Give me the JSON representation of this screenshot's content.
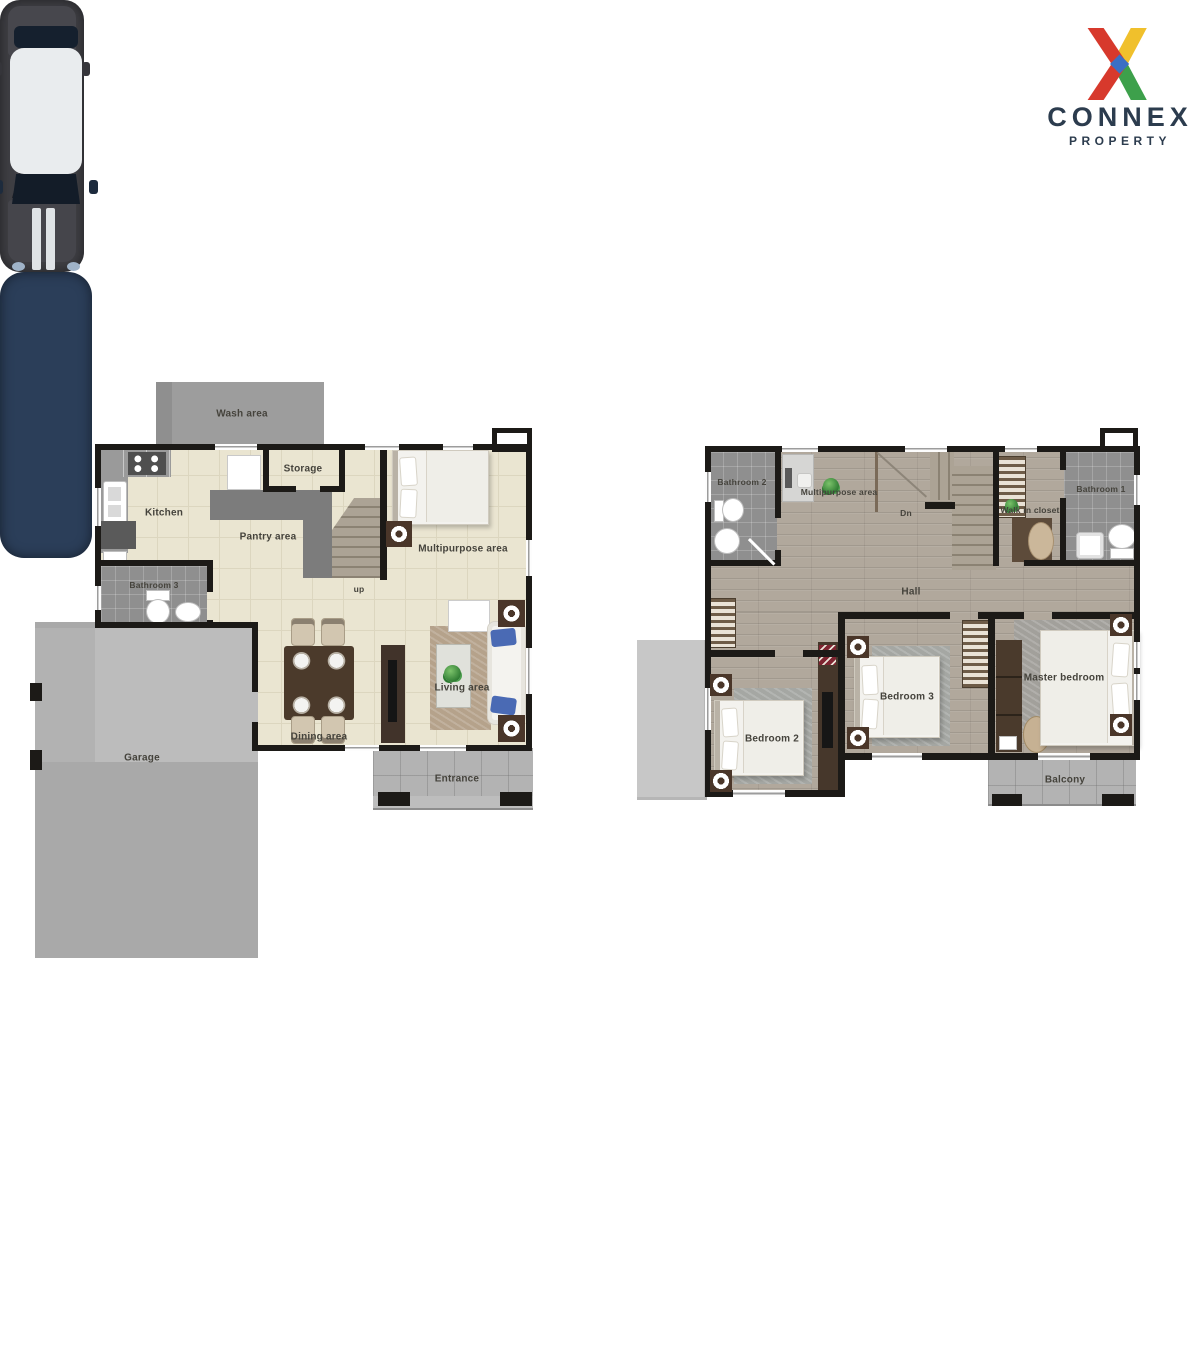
{
  "logo": {
    "brand": "CONNEX",
    "tagline": "PROPERTY",
    "icon": "connex-x-logo",
    "colors": {
      "red": "#d7392c",
      "yellow": "#f0c02c",
      "green": "#3da04b",
      "blue": "#3b6fc4",
      "text": "#2c3c4e"
    }
  },
  "floor1": {
    "labels": {
      "wash_area": "Wash area",
      "kitchen": "Kitchen",
      "storage": "Storage",
      "pantry_area": "Pantry area",
      "multipurpose_area": "Multipurpose area",
      "bathroom3": "Bathroom 3",
      "stairs_up": "up",
      "garage": "Garage",
      "dining_area": "Dining area",
      "living_area": "Living area",
      "entrance": "Entrance"
    }
  },
  "floor2": {
    "labels": {
      "bathroom2": "Bathroom 2",
      "multipurpose_area": "Multipurpose area",
      "stairs_down": "Dn",
      "walk_in_closet": "Walk in closet",
      "bathroom1": "Bathroom 1",
      "hall": "Hall",
      "bedroom2": "Bedroom 2",
      "bedroom3": "Bedroom 3",
      "master_bedroom": "Master bedroom",
      "balcony": "Balcony"
    }
  }
}
